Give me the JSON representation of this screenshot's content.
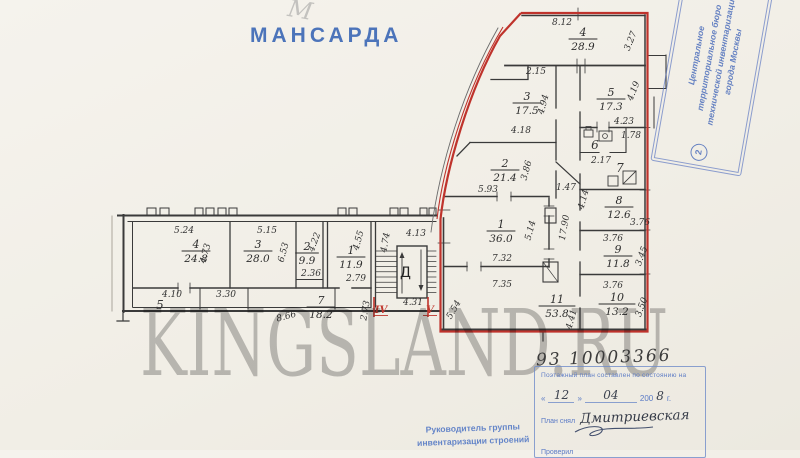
{
  "page": {
    "title": "МАНСАРДА",
    "pencil_note": "М",
    "watermark": "KINGSLAND.RU",
    "inventory_number": "93 10003366"
  },
  "bureau_stamp": {
    "number": "2",
    "lines": [
      "Центральное",
      "территориальное бюро",
      "технической инвентаризации",
      "города Москвы"
    ]
  },
  "date_stamp": {
    "header": "Поэтажный план составлен по состоянию на",
    "quote_open": "«",
    "quote_close": "»",
    "day": "12",
    "month": "04",
    "year_prefix": "200",
    "year_digit": "8",
    "year_suffix": "г.",
    "surveyor_label": "План снял",
    "surveyor_name": "Дмитриевская",
    "checker_label": "Проверил"
  },
  "footer": {
    "line1": "Руководитель группы",
    "line2": "инвентаризации строений"
  },
  "colors": {
    "red_outline": "#bf332c",
    "stamp_blue": "#5272bd",
    "ink": "#3a3a3a",
    "paper": "#f1eee6"
  },
  "plan": {
    "stair_letter": "Д",
    "rooms": [
      {
        "n": "4",
        "a": "28.9",
        "x": 583,
        "y": 36
      },
      {
        "n": "3",
        "a": "17.5",
        "x": 527,
        "y": 100
      },
      {
        "n": "5",
        "a": "17.3",
        "x": 611,
        "y": 96
      },
      {
        "n": "2",
        "a": "21.4",
        "x": 505,
        "y": 167
      },
      {
        "n": "1",
        "a": "36.0",
        "x": 501,
        "y": 228
      },
      {
        "n": "11",
        "a": "53.8",
        "x": 557,
        "y": 303
      },
      {
        "n": "8",
        "a": "12.6",
        "x": 619,
        "y": 204
      },
      {
        "n": "9",
        "a": "11.8",
        "x": 618,
        "y": 253
      },
      {
        "n": "10",
        "a": "13.2",
        "x": 617,
        "y": 301
      },
      {
        "n": "4",
        "a": "24.8",
        "x": 196,
        "y": 248
      },
      {
        "n": "3",
        "a": "28.0",
        "x": 258,
        "y": 248
      },
      {
        "n": "2",
        "a": "9.9",
        "x": 307,
        "y": 250
      },
      {
        "n": "1",
        "a": "11.9",
        "x": 351,
        "y": 254
      },
      {
        "n": "7",
        "a": "18.2",
        "x": 321,
        "y": 304
      }
    ],
    "dims": [
      {
        "t": "8.12",
        "x": 562,
        "y": 25
      },
      {
        "t": "3.27",
        "x": 633,
        "y": 42,
        "r": -68
      },
      {
        "t": "2.15",
        "x": 536,
        "y": 74
      },
      {
        "t": "4.94",
        "x": 546,
        "y": 105,
        "r": -75
      },
      {
        "t": "4.18",
        "x": 521,
        "y": 133
      },
      {
        "t": "4.19",
        "x": 636,
        "y": 92,
        "r": -68
      },
      {
        "t": "4.23",
        "x": 624,
        "y": 124
      },
      {
        "t": "6",
        "x": 595,
        "y": 149,
        "s": 12
      },
      {
        "t": "1.78",
        "x": 631,
        "y": 138
      },
      {
        "t": "2.17",
        "x": 601,
        "y": 163
      },
      {
        "t": "7",
        "x": 620,
        "y": 172,
        "s": 12
      },
      {
        "t": "3.86",
        "x": 529,
        "y": 171,
        "r": -75
      },
      {
        "t": "5.93",
        "x": 488,
        "y": 192
      },
      {
        "t": "1.47",
        "x": 566,
        "y": 190
      },
      {
        "t": "5.14",
        "x": 533,
        "y": 231,
        "r": -75
      },
      {
        "t": "7.32",
        "x": 502,
        "y": 261
      },
      {
        "t": "7.35",
        "x": 502,
        "y": 287
      },
      {
        "t": "17.90",
        "x": 567,
        "y": 228,
        "r": -80
      },
      {
        "t": "4.14",
        "x": 586,
        "y": 200,
        "r": -75
      },
      {
        "t": "4.41",
        "x": 574,
        "y": 320,
        "r": -75
      },
      {
        "t": "5.54",
        "x": 456,
        "y": 311,
        "r": -60
      },
      {
        "t": "3.76",
        "x": 640,
        "y": 225
      },
      {
        "t": "3.76",
        "x": 613,
        "y": 241
      },
      {
        "t": "3.45",
        "x": 644,
        "y": 257,
        "r": -70
      },
      {
        "t": "3.76",
        "x": 613,
        "y": 288
      },
      {
        "t": "3.50",
        "x": 644,
        "y": 308,
        "r": -70
      },
      {
        "t": "5.24",
        "x": 184,
        "y": 233
      },
      {
        "t": "4.73",
        "x": 208,
        "y": 254,
        "r": -75
      },
      {
        "t": "5.15",
        "x": 267,
        "y": 233
      },
      {
        "t": "6.53",
        "x": 286,
        "y": 253,
        "r": -75
      },
      {
        "t": "4.22",
        "x": 317,
        "y": 243,
        "r": -70
      },
      {
        "t": "2.36",
        "x": 311,
        "y": 276
      },
      {
        "t": "4.55",
        "x": 361,
        "y": 241,
        "r": -75
      },
      {
        "t": "2.79",
        "x": 356,
        "y": 281
      },
      {
        "t": "4.13",
        "x": 416,
        "y": 236
      },
      {
        "t": "4.74",
        "x": 388,
        "y": 243,
        "r": -80
      },
      {
        "t": "4.31",
        "x": 413,
        "y": 305
      },
      {
        "t": "2.73",
        "x": 368,
        "y": 311,
        "r": -80
      },
      {
        "t": "4.10",
        "x": 172,
        "y": 297
      },
      {
        "t": "5",
        "x": 160,
        "y": 309,
        "s": 12
      },
      {
        "t": "3.30",
        "x": 226,
        "y": 297
      },
      {
        "t": "8.66",
        "x": 287,
        "y": 319,
        "r": -15
      }
    ],
    "marks": [
      {
        "t": "IV",
        "x": 381,
        "y": 313
      },
      {
        "t": "V",
        "x": 430,
        "y": 313
      }
    ]
  }
}
